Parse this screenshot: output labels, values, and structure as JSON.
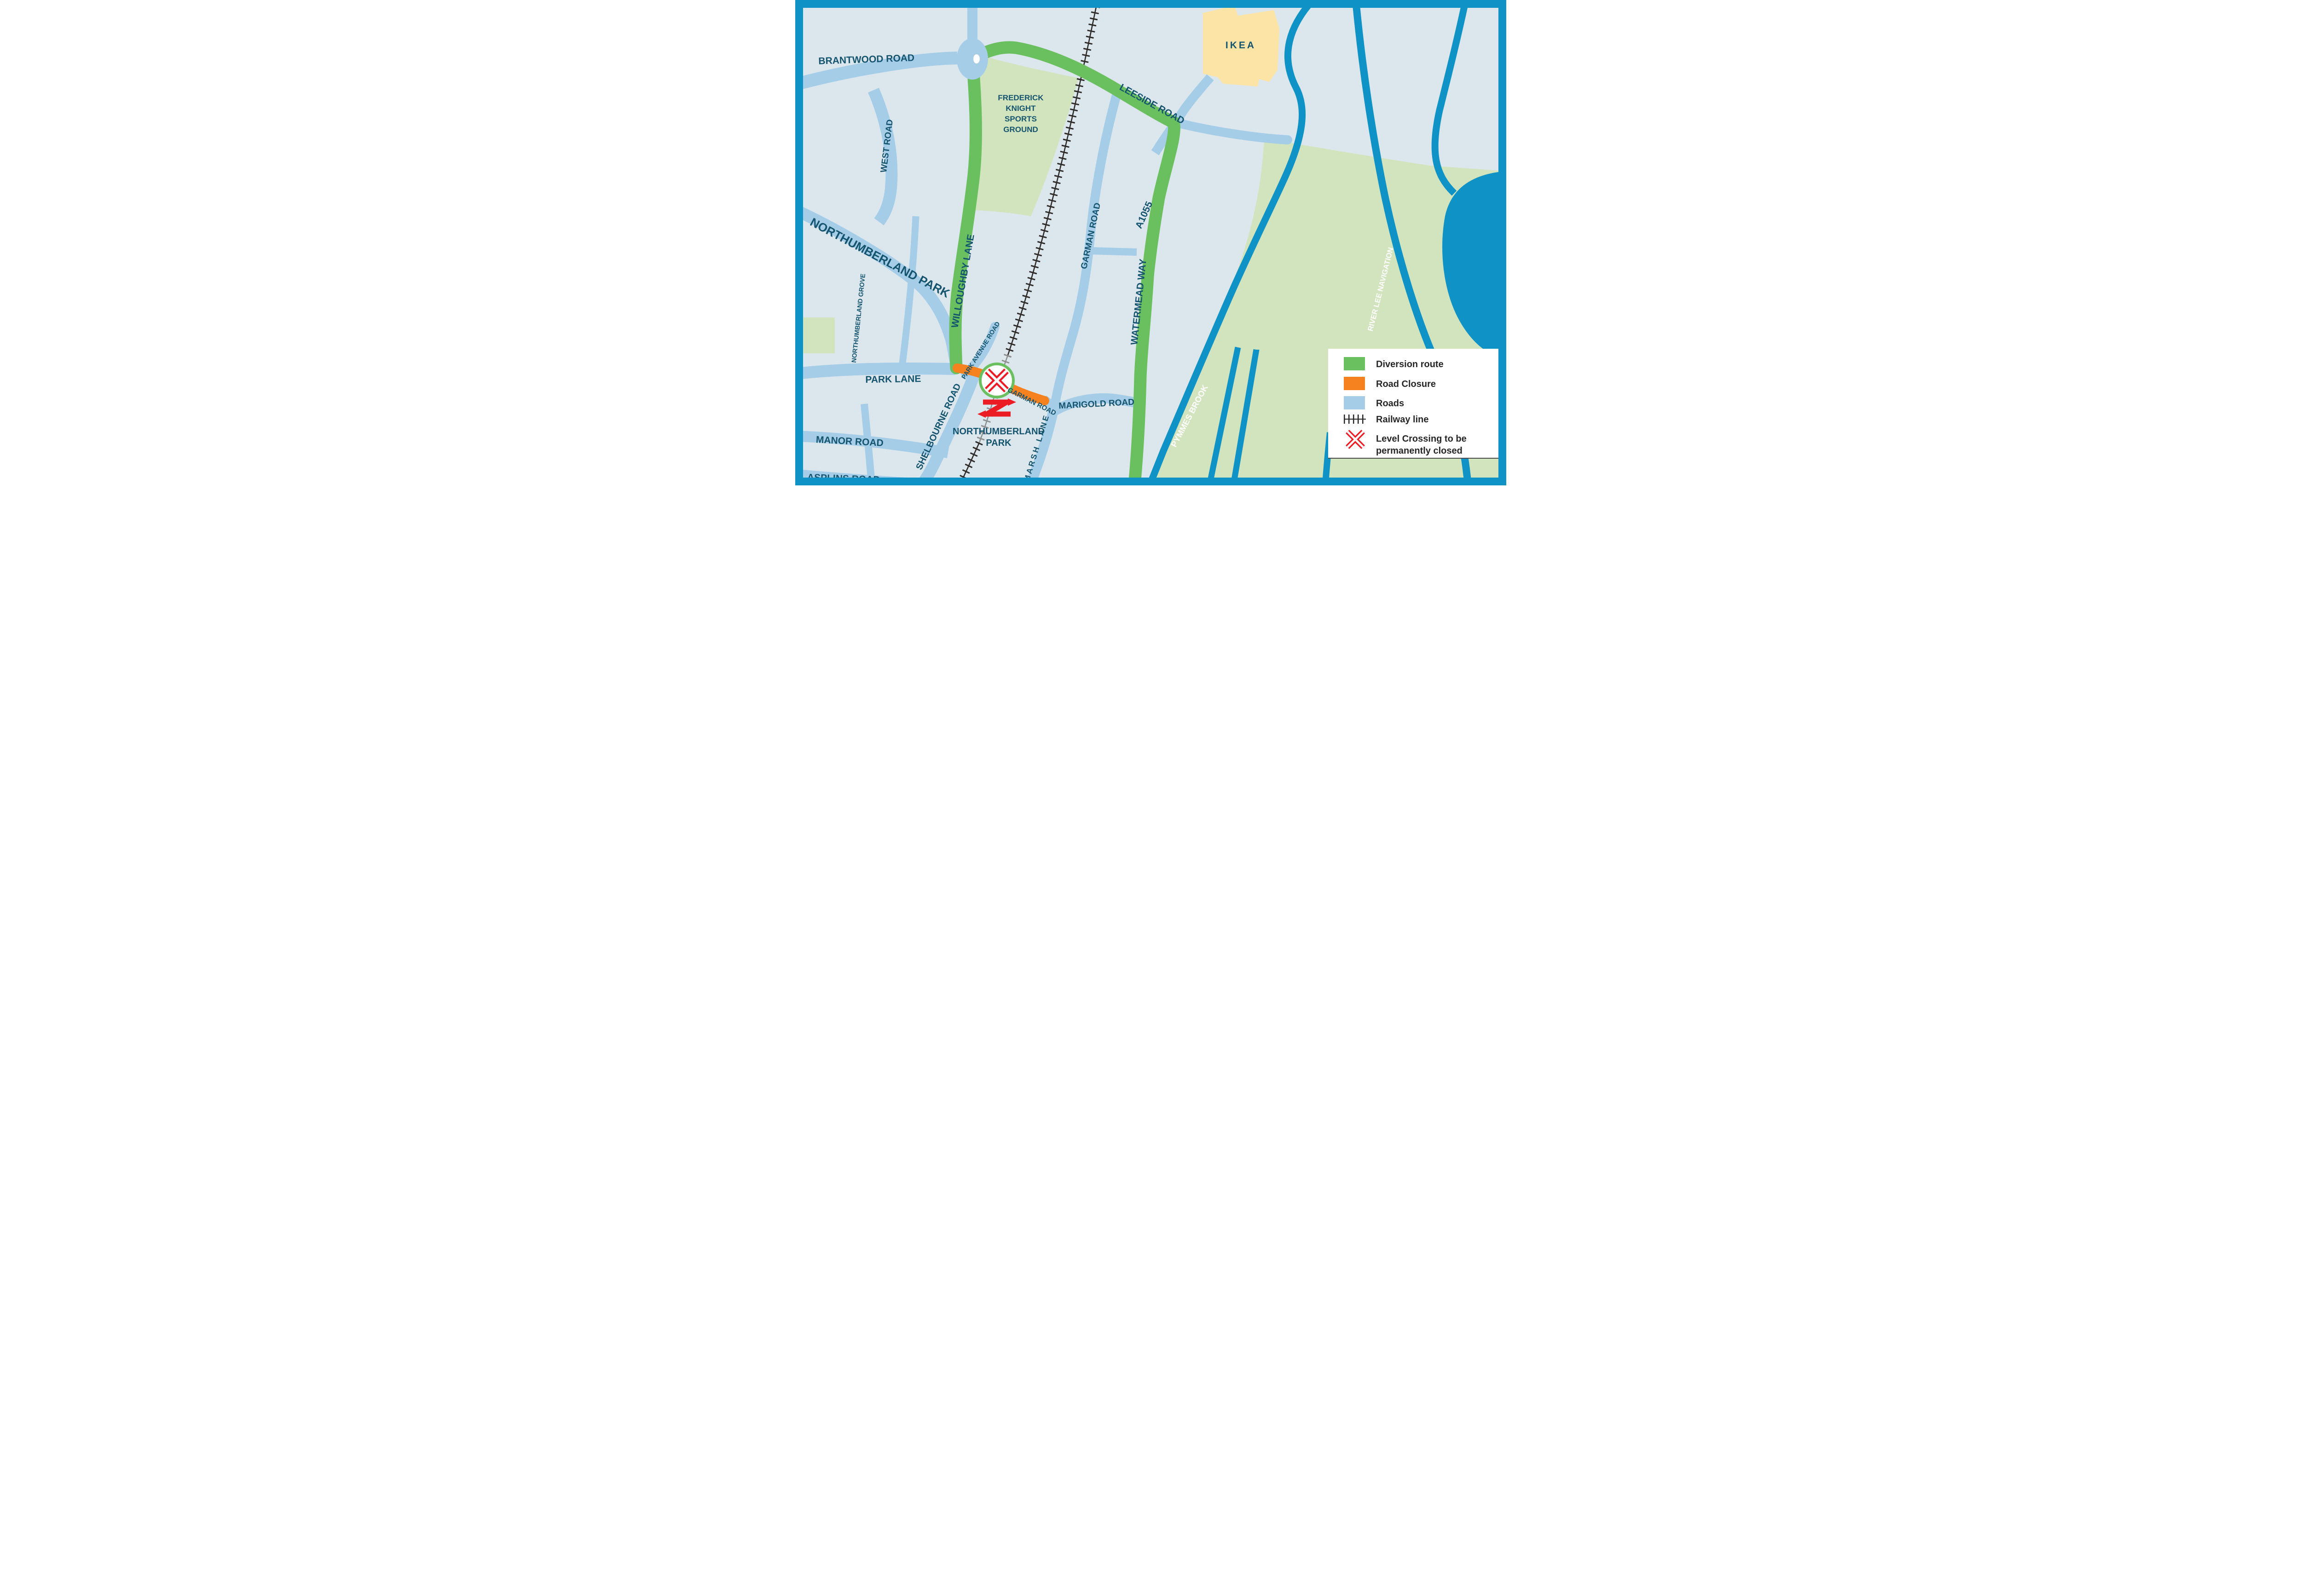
{
  "map": {
    "labels": {
      "brantwood": "BRANTWOOD ROAD",
      "west_road": "WEST ROAD",
      "northumberland_park_road": "NORTHUMBERLAND PARK",
      "northumberland_grove": "NORTHUMBERLAND GROVE",
      "willoughby": "WILLOUGHBY LANE",
      "park_avenue": "PARK AVENUE ROAD",
      "park_lane": "PARK LANE",
      "shelbourne": "SHELBOURNE ROAD",
      "manor": "MANOR ROAD",
      "asplins": "ASPLINS ROAD",
      "marsh": "MARSH LANE",
      "marigold": "MARIGOLD ROAD",
      "garman_upper": "GARMAN ROAD",
      "garman_lower": "GARMAN ROAD",
      "leeside": "LEESIDE ROAD",
      "a1055": "A1055",
      "watermead": "WATERMEAD WAY",
      "pymmes": "PYMMES BROOK",
      "river_lee": "RIVER LEE NAVIGATION",
      "ikea": "IKEA",
      "frederick": [
        "FREDERICK",
        "KNIGHT",
        "SPORTS",
        "GROUND"
      ],
      "station": [
        "NORTHUMBERLAND",
        "PARK"
      ]
    }
  },
  "legend": {
    "items": [
      {
        "label": "Diversion route",
        "type": "color",
        "color": "#6abf5f"
      },
      {
        "label": "Road Closure",
        "type": "color",
        "color": "#f5821f"
      },
      {
        "label": "Roads",
        "type": "color",
        "color": "#a5cde8"
      },
      {
        "label": "Railway line",
        "type": "railway"
      },
      {
        "label": "Level Crossing to be",
        "label_line2": "permanently closed",
        "type": "crossing"
      }
    ]
  },
  "colors": {
    "bg": "#dce6ed",
    "water": "#0f93c6",
    "road": "#a5cde8",
    "green-route": "#6abf5f",
    "area-green": "#d2e4bd",
    "closure": "#f5821f",
    "label": "#14546f",
    "red": "#ec1c24",
    "rail": "#2e2b28",
    "rail-grey": "#8f8f8f",
    "ikea": "#fbe4a6",
    "legend-text": "#262626"
  }
}
